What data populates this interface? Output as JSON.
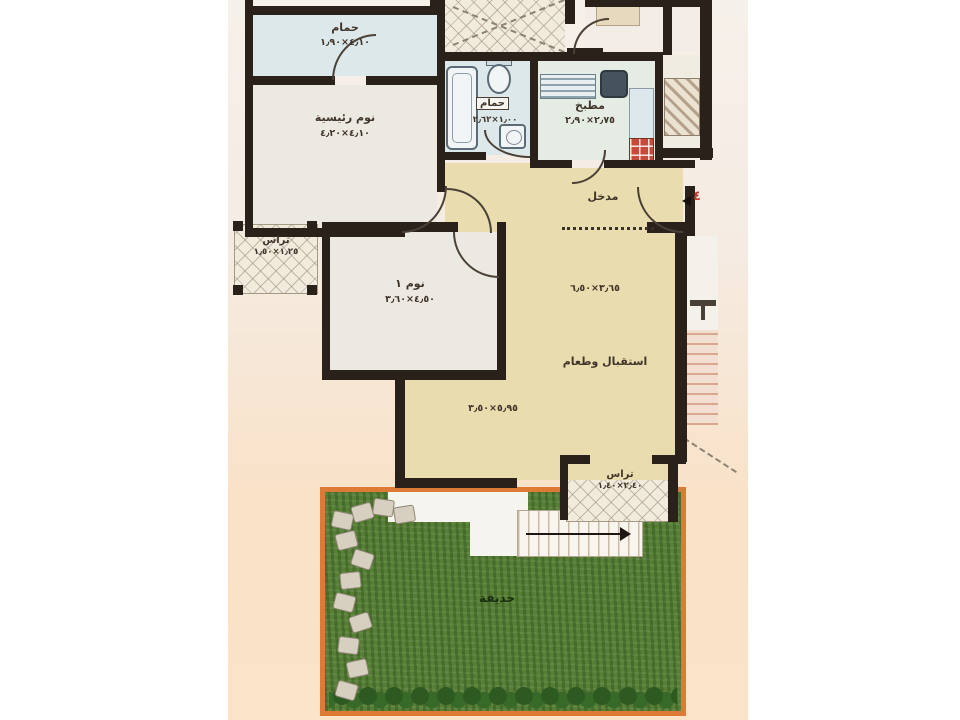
{
  "unit": {
    "number": "٤"
  },
  "rooms": {
    "bath_top": {
      "label": "حمام",
      "dims": "٤٫١٠×١٫٩٠"
    },
    "master_bedroom": {
      "label": "نوم رئيسية",
      "dims": "٤٫١٠×٤٫٢٠"
    },
    "bath_small": {
      "label": "حمام",
      "dims": "١٫٠٠×٢٫٦٢"
    },
    "kitchen": {
      "label": "مطبخ",
      "dims": "٢٫٧٥×٢٫٩٠"
    },
    "entrance": {
      "label": "مدخل"
    },
    "bedroom_1": {
      "label": "نوم ١",
      "dims": "٤٫٥٠×٣٫٦٠"
    },
    "reception": {
      "label": "استقبال وطعام",
      "dims_upper": "٣٫٦٥×٦٫٥٠",
      "dims_lower": "٥٫٩٥×٣٫٥٠"
    },
    "terrace_left": {
      "label": "تراس",
      "dims": "١٫٢٥×١٫٥٠"
    },
    "terrace_bottom": {
      "label": "تراس",
      "dims": "٢٫٤٠×١٫٤٠"
    },
    "garden": {
      "label": "حديقة"
    }
  },
  "colors": {
    "wall": "#2a211b",
    "beige_floor": "#e9dcae",
    "blue_floor": "#dce8ea",
    "white_floor": "#ece9e2",
    "tile_floor": "#f1ebde",
    "garden_green": "#567f35",
    "garden_border": "#dd7b36",
    "accent_red": "#c0392b"
  }
}
